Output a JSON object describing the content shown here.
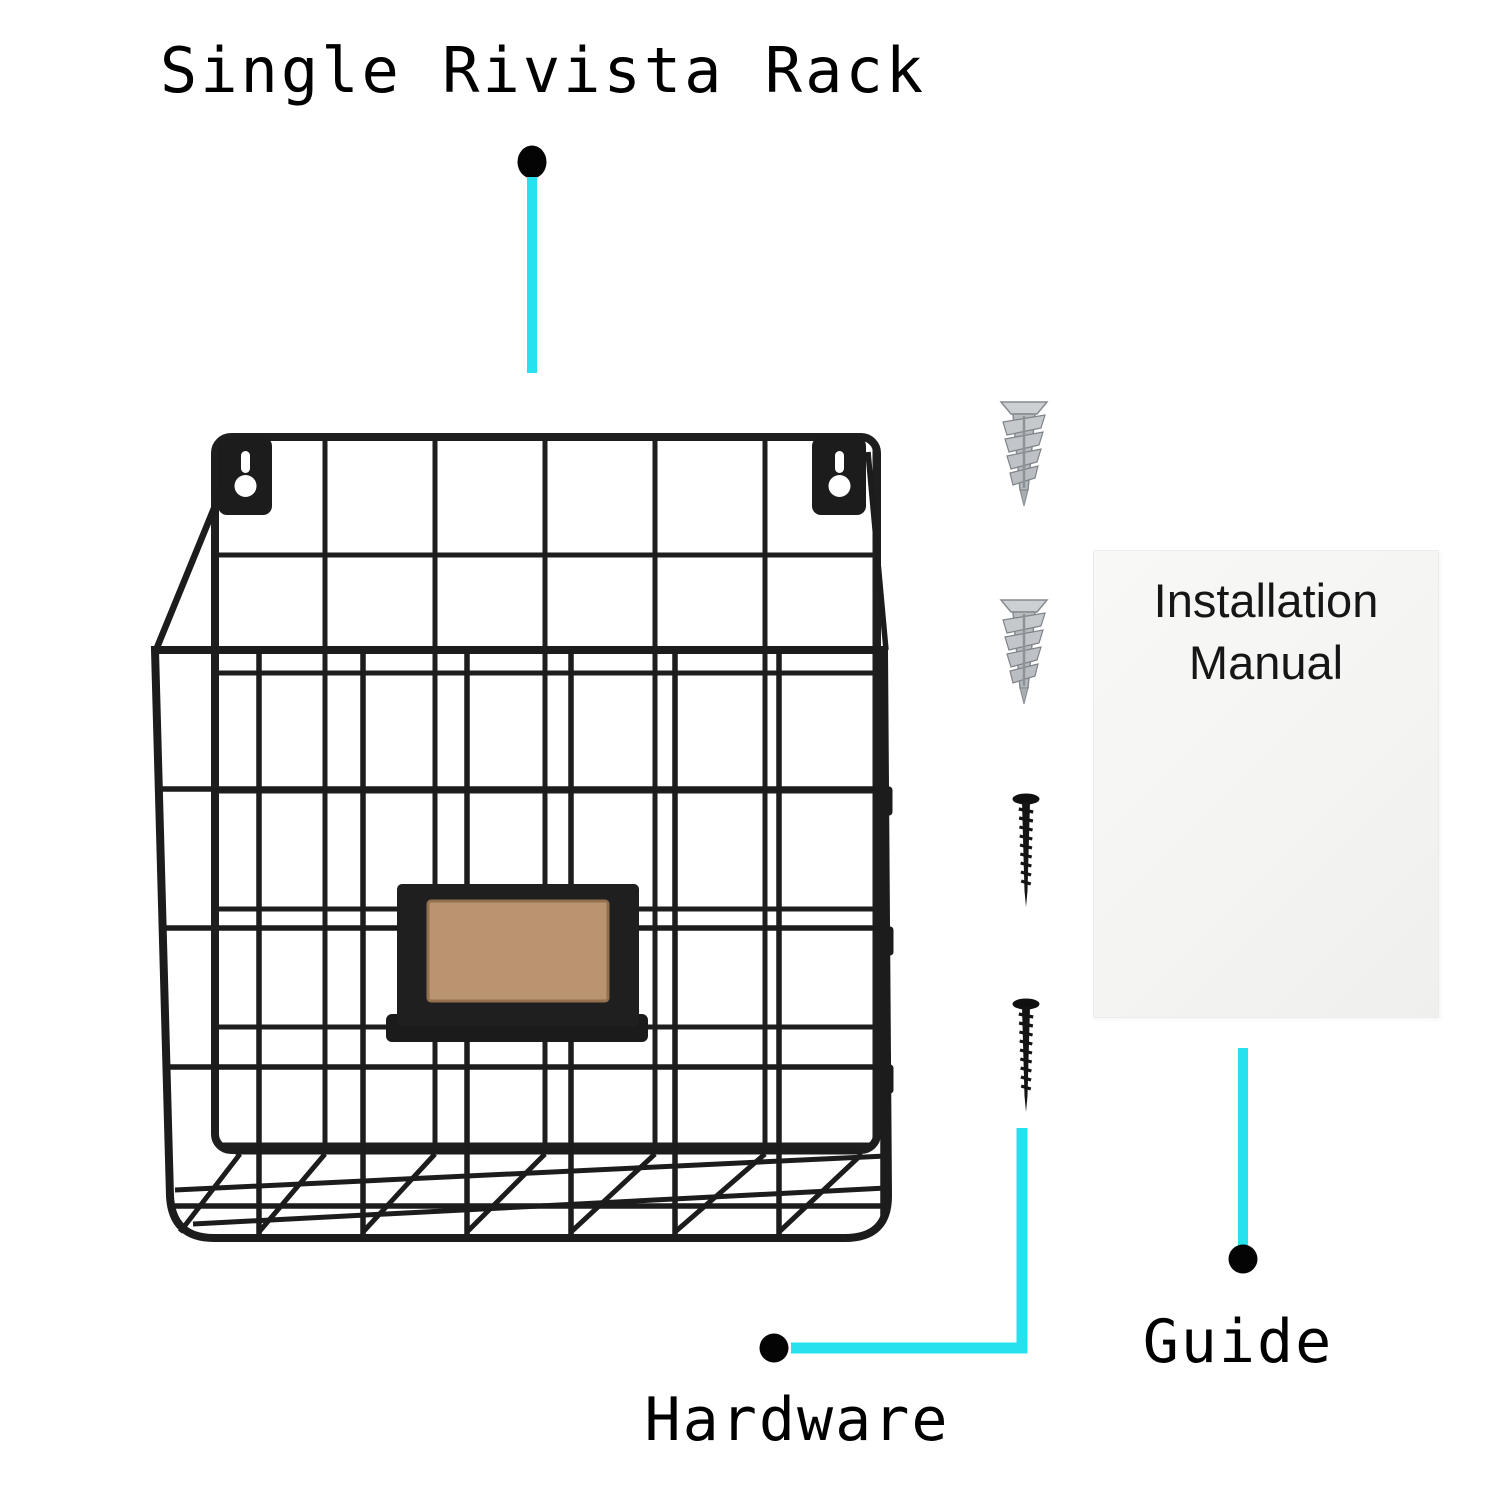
{
  "labels": {
    "rack": "Single Rivista Rack",
    "hardware": "Hardware",
    "guide": "Guide",
    "manual": "Installation Manual"
  },
  "colors": {
    "accent_cyan": "#26E2EF",
    "wire_black": "#1E1E1E",
    "label_insert_tan": "#BA9370",
    "anchor_metal": "#B7BBC0",
    "manual_card": "#F5F5F3",
    "text": "#000000"
  },
  "hardware_items": {
    "drywall_anchor_count": 2,
    "screw_count": 2
  }
}
